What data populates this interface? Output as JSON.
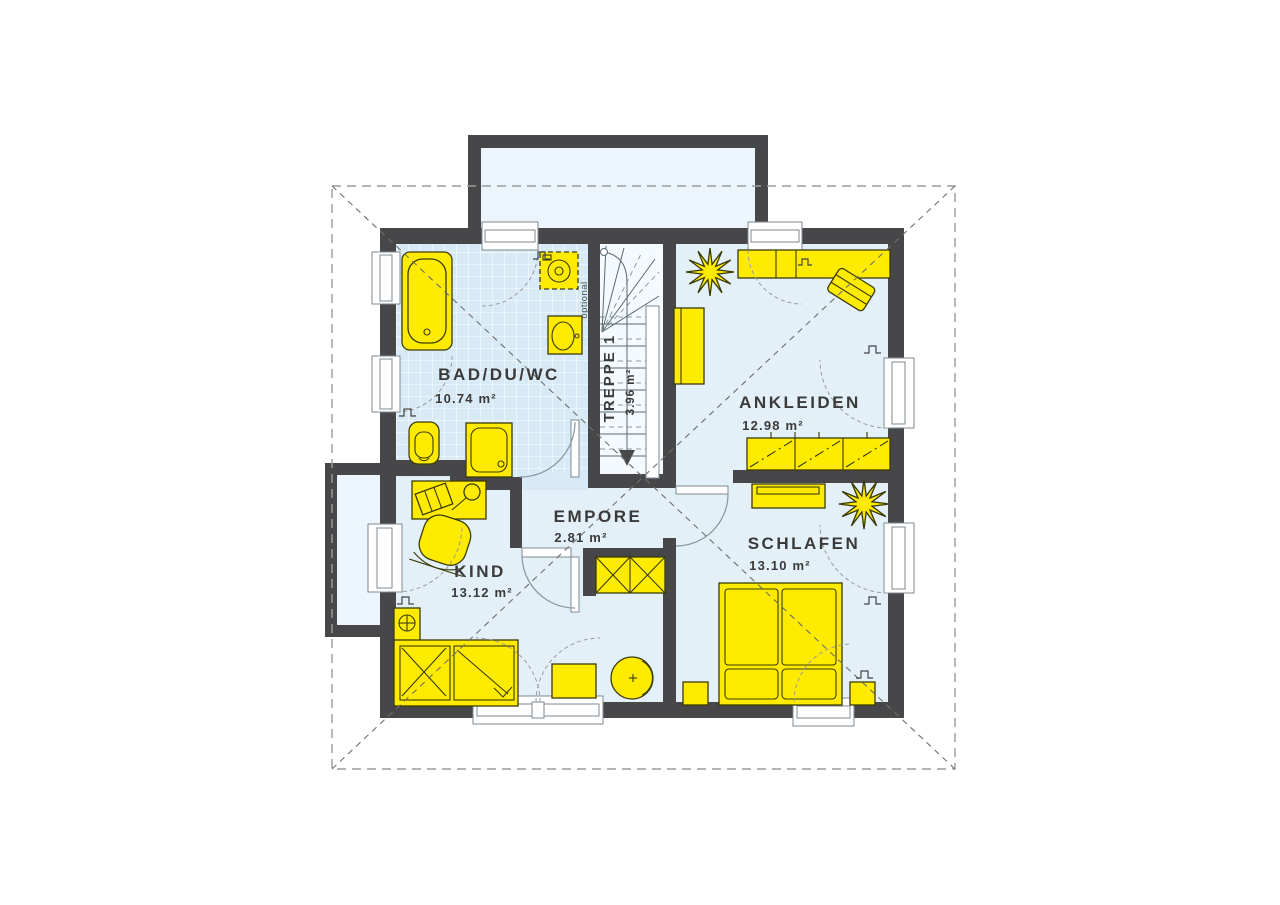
{
  "plan": {
    "rooms": [
      {
        "key": "bad",
        "name": "BAD/DU/WC",
        "area": "10.74 m²"
      },
      {
        "key": "treppe",
        "name": "TREPPE 1",
        "area": "3.96 m²"
      },
      {
        "key": "ankleiden",
        "name": "ANKLEIDEN",
        "area": "12.98 m²"
      },
      {
        "key": "empore",
        "name": "EMPORE",
        "area": "2.81 m²"
      },
      {
        "key": "kind",
        "name": "KIND",
        "area": "13.12 m²"
      },
      {
        "key": "schlafen",
        "name": "SCHLAFEN",
        "area": "13.10 m²"
      }
    ],
    "labels": {
      "optional": "optional"
    },
    "colors": {
      "wall": "#474749",
      "furniture": "#ffeb00",
      "floor": "#e3f0f8",
      "tile_floor": "#d7eaf6",
      "stair_floor": "#f4fafd",
      "annex_floor": "#ebf5fb",
      "text": "#3a3a3a",
      "roof_dash": "#9b9b9b"
    }
  }
}
